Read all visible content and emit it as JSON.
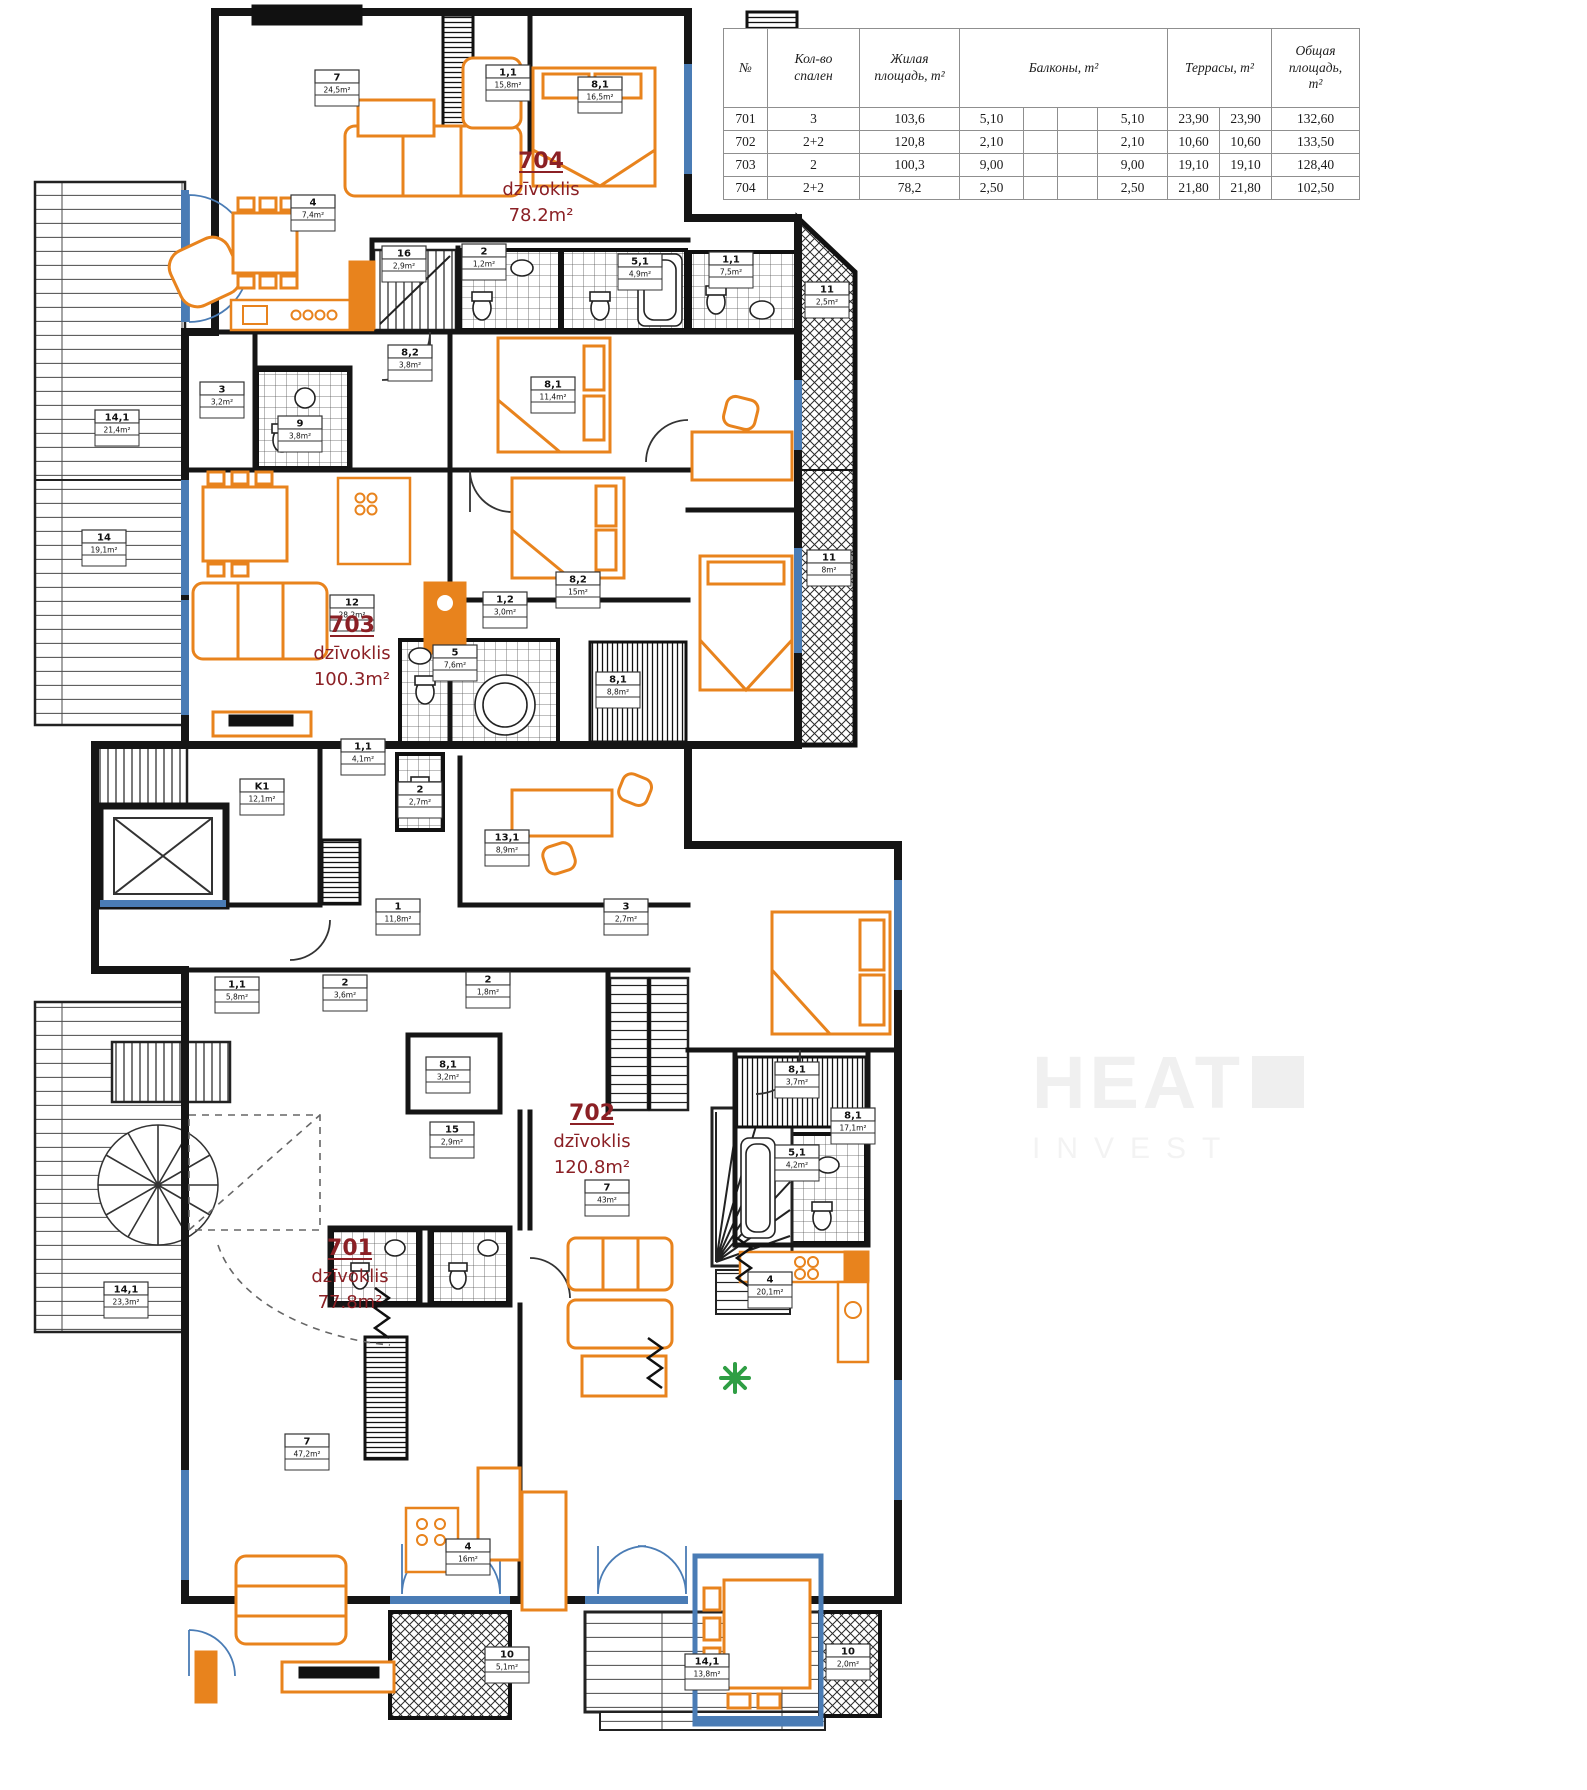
{
  "colors": {
    "wall": "#151515",
    "furniture": "#E8831D",
    "window": "#4A7CB5",
    "label": "#8B2025",
    "plant": "#2F9E44",
    "watermark": "#F0F0F0"
  },
  "watermark": {
    "line1": "HEAT",
    "line2": "INVEST"
  },
  "table": {
    "headers": {
      "num": "№",
      "bedrooms": "Кол-во\nспален",
      "living": "Жилая\nплощадь, m²",
      "balconies": "Балконы, m²",
      "terraces": "Террасы, m²",
      "total": "Общая\nплощадь,\nm²"
    },
    "rows": [
      {
        "num": "701",
        "bedrooms": "3",
        "living": "103,6",
        "b1": "5,10",
        "b2": "",
        "b3": "",
        "bsum": "5,10",
        "t1": "23,90",
        "tsum": "23,90",
        "total": "132,60"
      },
      {
        "num": "702",
        "bedrooms": "2+2",
        "living": "120,8",
        "b1": "2,10",
        "b2": "",
        "b3": "",
        "bsum": "2,10",
        "t1": "10,60",
        "tsum": "10,60",
        "total": "133,50"
      },
      {
        "num": "703",
        "bedrooms": "2",
        "living": "100,3",
        "b1": "9,00",
        "b2": "",
        "b3": "",
        "bsum": "9,00",
        "t1": "19,10",
        "tsum": "19,10",
        "total": "128,40"
      },
      {
        "num": "704",
        "bedrooms": "2+2",
        "living": "78,2",
        "b1": "2,50",
        "b2": "",
        "b3": "",
        "bsum": "2,50",
        "t1": "21,80",
        "tsum": "21,80",
        "total": "102,50"
      }
    ]
  },
  "apartments": [
    {
      "number": "704",
      "type": "dzīvoklis",
      "area": "78.2m²",
      "x": 541,
      "y": 168
    },
    {
      "number": "703",
      "type": "dzīvoklis",
      "area": "100.3m²",
      "x": 352,
      "y": 632
    },
    {
      "number": "702",
      "type": "dzīvoklis",
      "area": "120.8m²",
      "x": 592,
      "y": 1120
    },
    {
      "number": "701",
      "type": "dzīvoklis",
      "area": "77.8m²",
      "x": 350,
      "y": 1255
    }
  ],
  "rooms": [
    {
      "id": "7",
      "area": "24,5m²",
      "x": 337,
      "y": 88
    },
    {
      "id": "1,1",
      "area": "15,8m²",
      "x": 508,
      "y": 83
    },
    {
      "id": "8,1",
      "area": "16,5m²",
      "x": 600,
      "y": 95
    },
    {
      "id": "4",
      "area": "7,4m²",
      "x": 313,
      "y": 213
    },
    {
      "id": "16",
      "area": "2,9m²",
      "x": 404,
      "y": 264
    },
    {
      "id": "2",
      "area": "1,2m²",
      "x": 484,
      "y": 262
    },
    {
      "id": "5,1",
      "area": "4,9m²",
      "x": 640,
      "y": 272
    },
    {
      "id": "1,1",
      "area": "7,5m²",
      "x": 731,
      "y": 270
    },
    {
      "id": "11",
      "area": "2,5m²",
      "x": 827,
      "y": 300
    },
    {
      "id": "11",
      "area": "8m²",
      "x": 829,
      "y": 568
    },
    {
      "id": "14,1",
      "area": "21,4m²",
      "x": 117,
      "y": 428
    },
    {
      "id": "14",
      "area": "19,1m²",
      "x": 104,
      "y": 548
    },
    {
      "id": "3",
      "area": "3,2m²",
      "x": 222,
      "y": 400
    },
    {
      "id": "9",
      "area": "3,8m²",
      "x": 300,
      "y": 434
    },
    {
      "id": "8,2",
      "area": "3,8m²",
      "x": 410,
      "y": 363
    },
    {
      "id": "8,1",
      "area": "11,4m²",
      "x": 553,
      "y": 395
    },
    {
      "id": "12",
      "area": "28,2m²",
      "x": 352,
      "y": 613
    },
    {
      "id": "1,2",
      "area": "3,0m²",
      "x": 505,
      "y": 610
    },
    {
      "id": "8,2",
      "area": "15m²",
      "x": 578,
      "y": 590
    },
    {
      "id": "8,1",
      "area": "8,8m²",
      "x": 618,
      "y": 690
    },
    {
      "id": "5",
      "area": "7,6m²",
      "x": 455,
      "y": 663
    },
    {
      "id": "1,1",
      "area": "4,1m²",
      "x": 363,
      "y": 757
    },
    {
      "id": "K1",
      "area": "12,1m²",
      "x": 262,
      "y": 797
    },
    {
      "id": "2",
      "area": "2,7m²",
      "x": 420,
      "y": 800
    },
    {
      "id": "13,1",
      "area": "8,9m²",
      "x": 507,
      "y": 848
    },
    {
      "id": "1",
      "area": "11,8m²",
      "x": 398,
      "y": 917
    },
    {
      "id": "3",
      "area": "2,7m²",
      "x": 626,
      "y": 917
    },
    {
      "id": "1,1",
      "area": "5,8m²",
      "x": 237,
      "y": 995
    },
    {
      "id": "2",
      "area": "3,6m²",
      "x": 345,
      "y": 993
    },
    {
      "id": "2",
      "area": "1,8m²",
      "x": 488,
      "y": 990
    },
    {
      "id": "8,1",
      "area": "3,2m²",
      "x": 448,
      "y": 1075
    },
    {
      "id": "15",
      "area": "2,9m²",
      "x": 452,
      "y": 1140
    },
    {
      "id": "8,1",
      "area": "17,1m²",
      "x": 853,
      "y": 1126
    },
    {
      "id": "8,1",
      "area": "3,7m²",
      "x": 797,
      "y": 1080
    },
    {
      "id": "5,1",
      "area": "4,2m²",
      "x": 797,
      "y": 1163
    },
    {
      "id": "7",
      "area": "43m²",
      "x": 607,
      "y": 1198
    },
    {
      "id": "14,1",
      "area": "23,3m²",
      "x": 126,
      "y": 1300
    },
    {
      "id": "7",
      "area": "47,2m²",
      "x": 307,
      "y": 1452
    },
    {
      "id": "4",
      "area": "16m²",
      "x": 468,
      "y": 1557
    },
    {
      "id": "4",
      "area": "20,1m²",
      "x": 770,
      "y": 1290
    },
    {
      "id": "10",
      "area": "5,1m²",
      "x": 507,
      "y": 1665
    },
    {
      "id": "14,1",
      "area": "13,8m²",
      "x": 707,
      "y": 1672
    },
    {
      "id": "10",
      "area": "2,0m²",
      "x": 848,
      "y": 1662
    }
  ]
}
